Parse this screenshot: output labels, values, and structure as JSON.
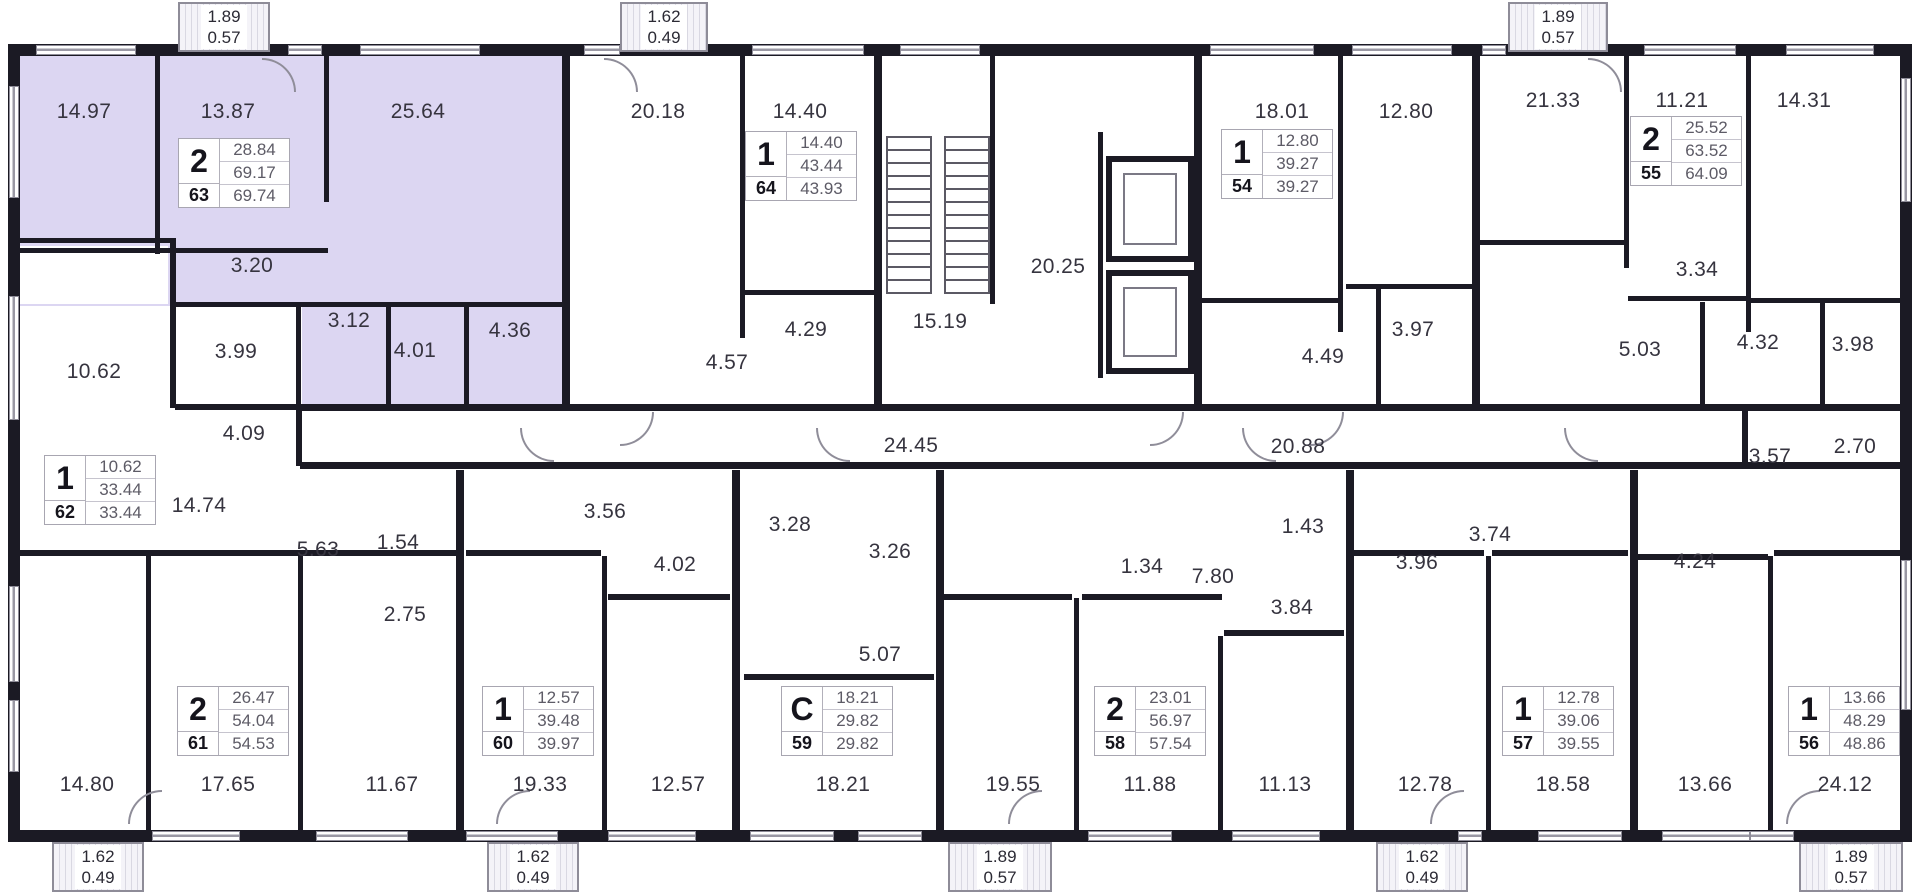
{
  "plan": {
    "highlight_color": "#dcd6f2",
    "wall_color": "#1b1a24",
    "apartments": [
      {
        "unit": "63",
        "rooms_type": "2",
        "values": [
          "28.84",
          "69.17",
          "69.74"
        ],
        "x": 178,
        "y": 138,
        "highlighted": true
      },
      {
        "unit": "64",
        "rooms_type": "1",
        "values": [
          "14.40",
          "43.44",
          "43.93"
        ],
        "x": 745,
        "y": 131,
        "highlighted": false
      },
      {
        "unit": "54",
        "rooms_type": "1",
        "values": [
          "12.80",
          "39.27",
          "39.27"
        ],
        "x": 1221,
        "y": 129,
        "highlighted": false
      },
      {
        "unit": "55",
        "rooms_type": "2",
        "values": [
          "25.52",
          "63.52",
          "64.09"
        ],
        "x": 1630,
        "y": 116,
        "highlighted": false
      },
      {
        "unit": "62",
        "rooms_type": "1",
        "values": [
          "10.62",
          "33.44",
          "33.44"
        ],
        "x": 44,
        "y": 455,
        "highlighted": false
      },
      {
        "unit": "61",
        "rooms_type": "2",
        "values": [
          "26.47",
          "54.04",
          "54.53"
        ],
        "x": 177,
        "y": 686,
        "highlighted": false
      },
      {
        "unit": "60",
        "rooms_type": "1",
        "values": [
          "12.57",
          "39.48",
          "39.97"
        ],
        "x": 482,
        "y": 686,
        "highlighted": false
      },
      {
        "unit": "59",
        "rooms_type": "C",
        "values": [
          "18.21",
          "29.82",
          "29.82"
        ],
        "x": 781,
        "y": 686,
        "highlighted": false
      },
      {
        "unit": "58",
        "rooms_type": "2",
        "values": [
          "23.01",
          "56.97",
          "57.54"
        ],
        "x": 1094,
        "y": 686,
        "highlighted": false
      },
      {
        "unit": "57",
        "rooms_type": "1",
        "values": [
          "12.78",
          "39.06",
          "39.55"
        ],
        "x": 1502,
        "y": 686,
        "highlighted": false
      },
      {
        "unit": "56",
        "rooms_type": "1",
        "values": [
          "13.66",
          "48.29",
          "48.86"
        ],
        "x": 1788,
        "y": 686,
        "highlighted": false
      }
    ],
    "room_labels": [
      {
        "t": "14.97",
        "x": 84,
        "y": 112
      },
      {
        "t": "13.87",
        "x": 228,
        "y": 112
      },
      {
        "t": "25.64",
        "x": 418,
        "y": 112
      },
      {
        "t": "20.18",
        "x": 658,
        "y": 112
      },
      {
        "t": "14.40",
        "x": 800,
        "y": 112
      },
      {
        "t": "18.01",
        "x": 1282,
        "y": 112
      },
      {
        "t": "12.80",
        "x": 1406,
        "y": 112
      },
      {
        "t": "21.33",
        "x": 1553,
        "y": 101
      },
      {
        "t": "11.21",
        "x": 1682,
        "y": 101
      },
      {
        "t": "14.31",
        "x": 1804,
        "y": 101
      },
      {
        "t": "20.25",
        "x": 1058,
        "y": 267
      },
      {
        "t": "15.19",
        "x": 940,
        "y": 322
      },
      {
        "t": "3.20",
        "x": 252,
        "y": 266
      },
      {
        "t": "3.99",
        "x": 236,
        "y": 352
      },
      {
        "t": "3.12",
        "x": 349,
        "y": 321
      },
      {
        "t": "4.01",
        "x": 415,
        "y": 351
      },
      {
        "t": "4.36",
        "x": 510,
        "y": 331
      },
      {
        "t": "10.62",
        "x": 94,
        "y": 372
      },
      {
        "t": "4.09",
        "x": 244,
        "y": 434
      },
      {
        "t": "14.74",
        "x": 199,
        "y": 506
      },
      {
        "t": "4.57",
        "x": 727,
        "y": 363
      },
      {
        "t": "4.29",
        "x": 806,
        "y": 330
      },
      {
        "t": "4.49",
        "x": 1323,
        "y": 357
      },
      {
        "t": "3.97",
        "x": 1413,
        "y": 330
      },
      {
        "t": "3.34",
        "x": 1697,
        "y": 270
      },
      {
        "t": "5.03",
        "x": 1640,
        "y": 350
      },
      {
        "t": "4.32",
        "x": 1758,
        "y": 343
      },
      {
        "t": "3.98",
        "x": 1853,
        "y": 345
      },
      {
        "t": "24.45",
        "x": 911,
        "y": 446
      },
      {
        "t": "20.88",
        "x": 1298,
        "y": 447
      },
      {
        "t": "3.57",
        "x": 1770,
        "y": 457
      },
      {
        "t": "2.70",
        "x": 1855,
        "y": 447
      },
      {
        "t": "5.63",
        "x": 318,
        "y": 550
      },
      {
        "t": "1.54",
        "x": 398,
        "y": 543
      },
      {
        "t": "2.75",
        "x": 405,
        "y": 615
      },
      {
        "t": "3.56",
        "x": 605,
        "y": 512
      },
      {
        "t": "4.02",
        "x": 675,
        "y": 565
      },
      {
        "t": "3.28",
        "x": 790,
        "y": 525
      },
      {
        "t": "3.26",
        "x": 890,
        "y": 552
      },
      {
        "t": "5.07",
        "x": 880,
        "y": 655
      },
      {
        "t": "1.34",
        "x": 1142,
        "y": 567
      },
      {
        "t": "7.80",
        "x": 1213,
        "y": 577
      },
      {
        "t": "1.43",
        "x": 1303,
        "y": 527
      },
      {
        "t": "3.84",
        "x": 1292,
        "y": 608
      },
      {
        "t": "3.96",
        "x": 1417,
        "y": 563
      },
      {
        "t": "3.74",
        "x": 1490,
        "y": 535
      },
      {
        "t": "4.24",
        "x": 1695,
        "y": 562
      },
      {
        "t": "14.80",
        "x": 87,
        "y": 785
      },
      {
        "t": "17.65",
        "x": 228,
        "y": 785
      },
      {
        "t": "11.67",
        "x": 392,
        "y": 785
      },
      {
        "t": "19.33",
        "x": 540,
        "y": 785
      },
      {
        "t": "12.57",
        "x": 678,
        "y": 785
      },
      {
        "t": "18.21",
        "x": 843,
        "y": 785
      },
      {
        "t": "19.55",
        "x": 1013,
        "y": 785
      },
      {
        "t": "11.88",
        "x": 1150,
        "y": 785
      },
      {
        "t": "11.13",
        "x": 1285,
        "y": 785
      },
      {
        "t": "12.78",
        "x": 1425,
        "y": 785
      },
      {
        "t": "18.58",
        "x": 1563,
        "y": 785
      },
      {
        "t": "13.66",
        "x": 1705,
        "y": 785
      },
      {
        "t": "24.12",
        "x": 1845,
        "y": 785
      }
    ],
    "balconies": {
      "top": [
        {
          "a": "1.89",
          "b": "0.57",
          "x": 178,
          "w": 92
        },
        {
          "a": "1.62",
          "b": "0.49",
          "x": 620,
          "w": 88
        },
        {
          "a": "1.89",
          "b": "0.57",
          "x": 1508,
          "w": 100
        }
      ],
      "bottom": [
        {
          "a": "1.62",
          "b": "0.49",
          "x": 52,
          "w": 92
        },
        {
          "a": "1.62",
          "b": "0.49",
          "x": 487,
          "w": 92
        },
        {
          "a": "1.89",
          "b": "0.57",
          "x": 948,
          "w": 104
        },
        {
          "a": "1.62",
          "b": "0.49",
          "x": 1376,
          "w": 92
        },
        {
          "a": "1.89",
          "b": "0.57",
          "x": 1799,
          "w": 104
        }
      ]
    }
  }
}
